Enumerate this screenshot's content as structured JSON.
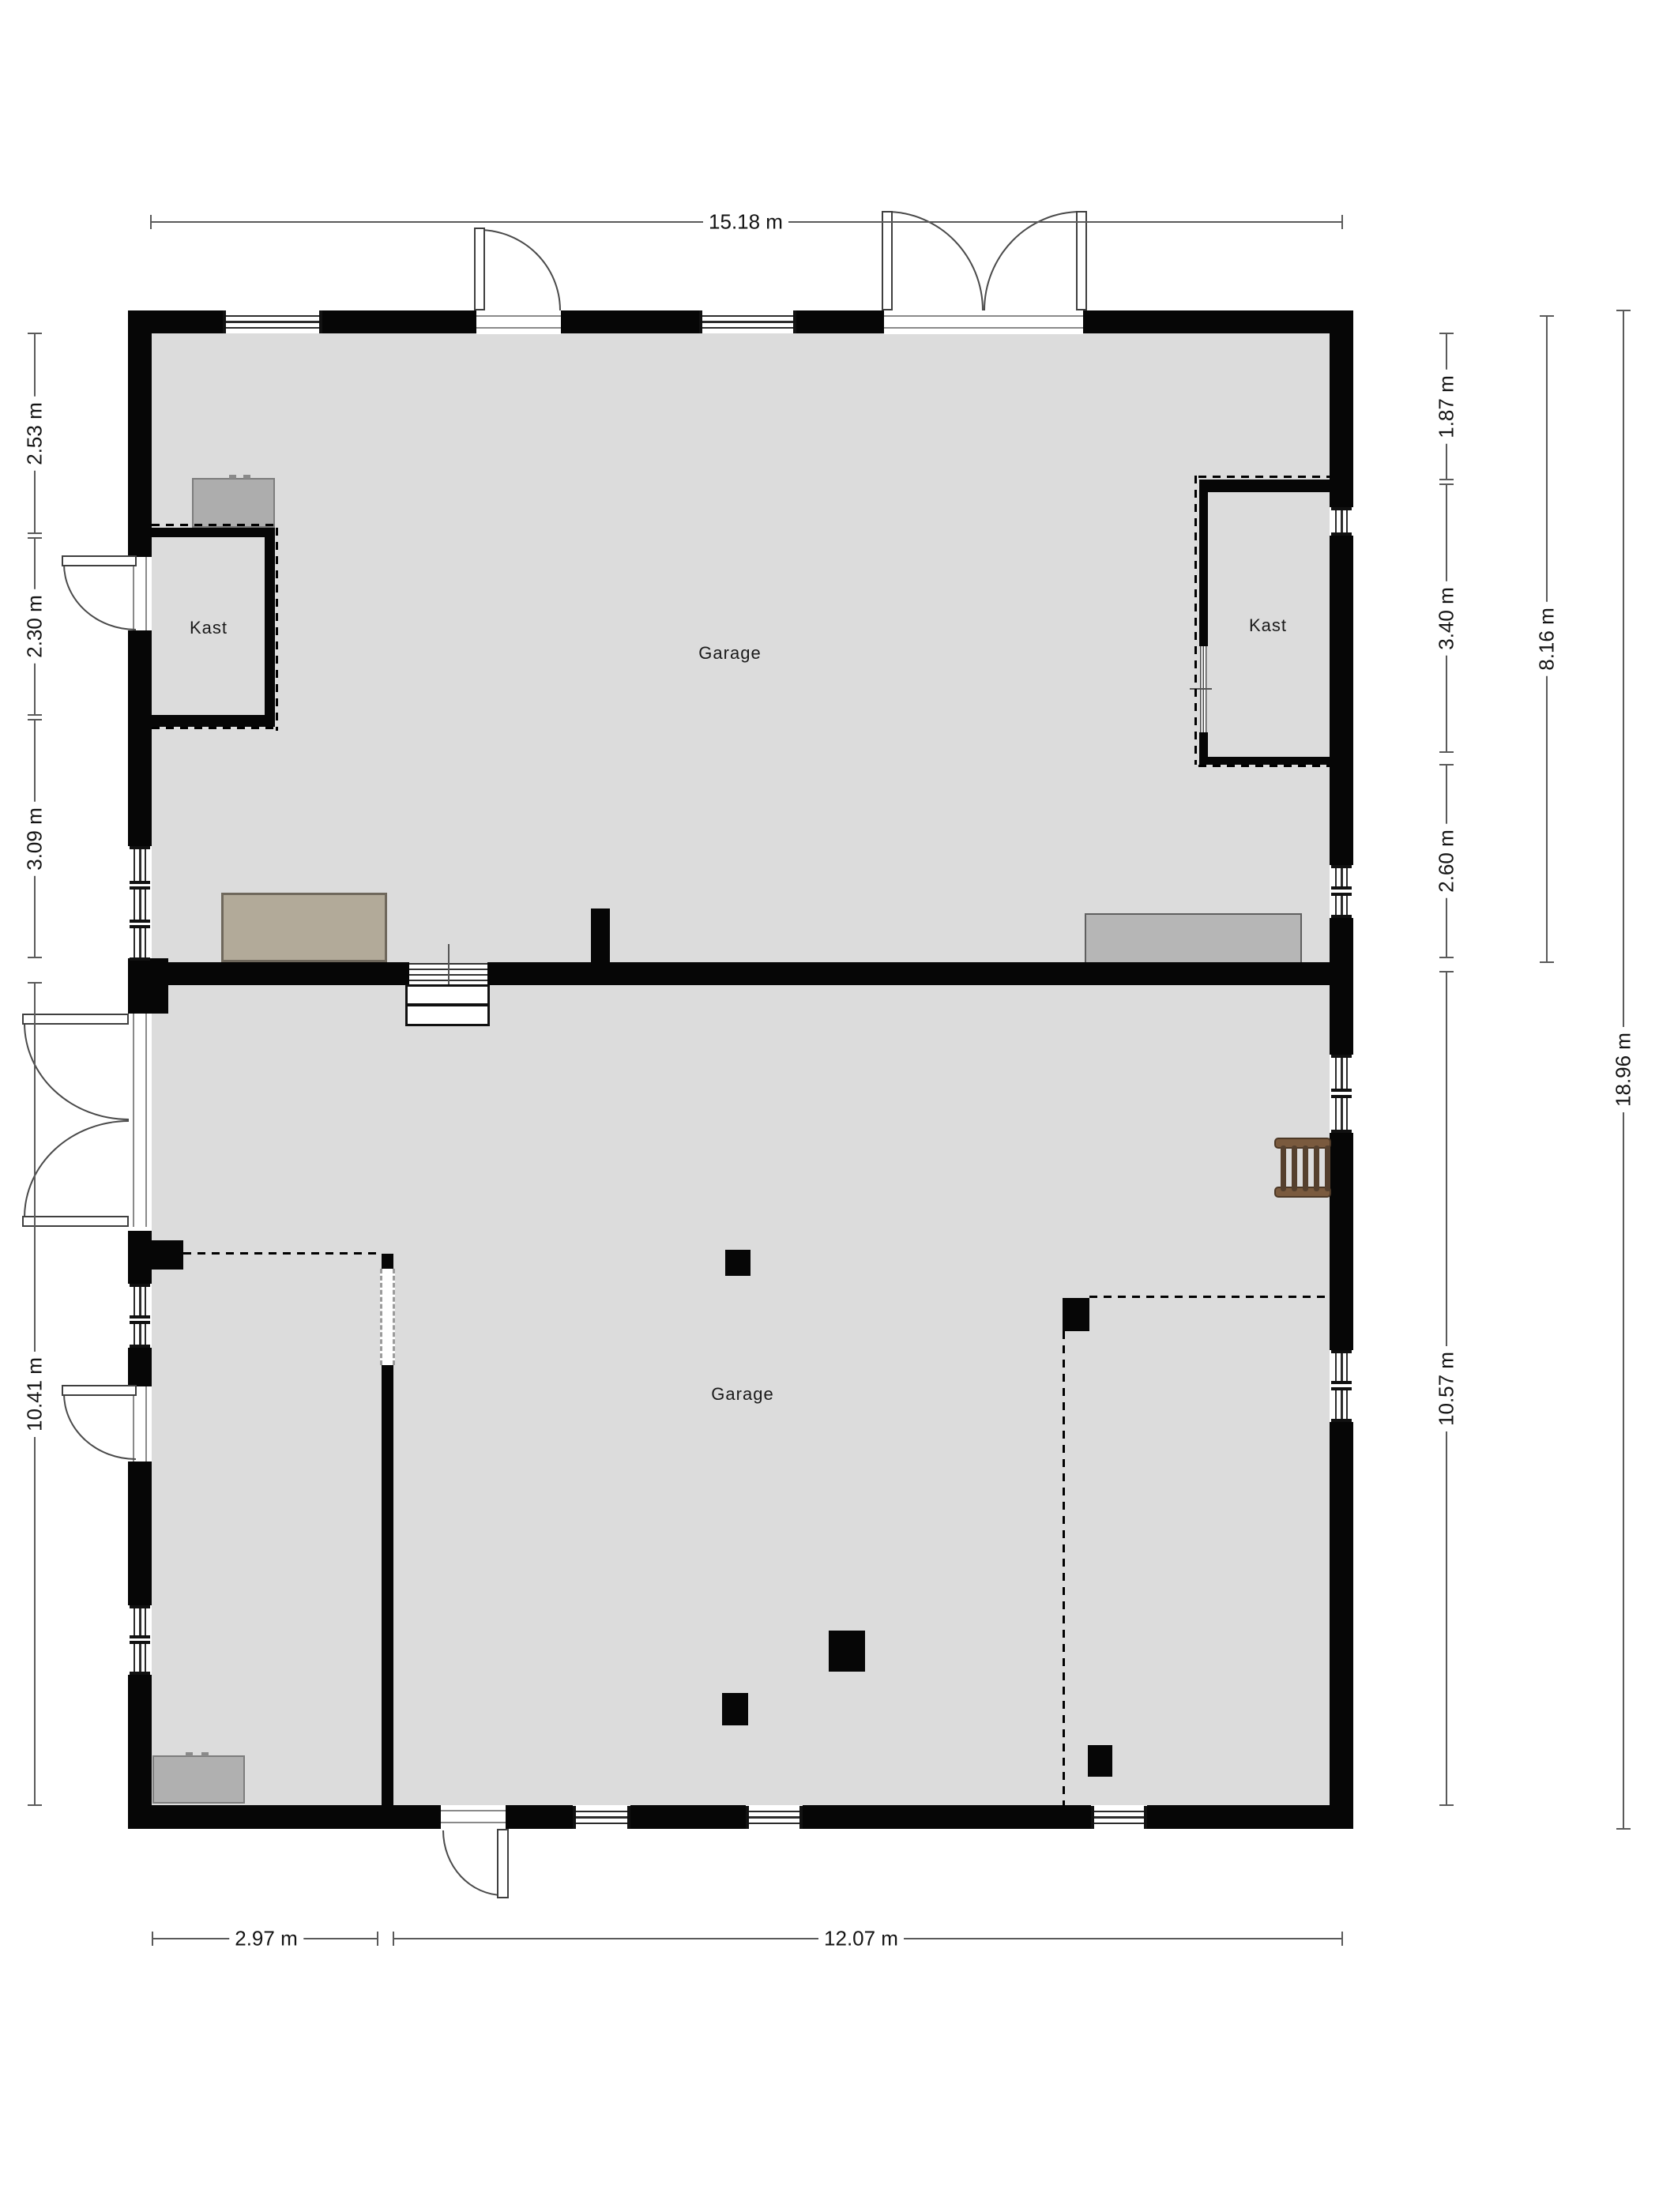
{
  "plan": {
    "rooms": [
      {
        "id": "garage-upper",
        "label": "Garage"
      },
      {
        "id": "garage-lower",
        "label": "Garage"
      },
      {
        "id": "kast-left",
        "label": "Kast"
      },
      {
        "id": "kast-right",
        "label": "Kast"
      }
    ],
    "dimensions": {
      "top_width": "15.18 m",
      "left": [
        "2.53 m",
        "2.30 m",
        "3.09 m",
        "10.41 m"
      ],
      "right_inner": [
        "1.87 m",
        "3.40 m",
        "2.60 m",
        "10.57 m"
      ],
      "right_total_upper": "8.16 m",
      "right_total": "18.96 m",
      "bottom": [
        "2.97 m",
        "12.07 m"
      ]
    },
    "colors": {
      "floor": "#dcdcdc",
      "wall": "#060606",
      "background": "#ffffff",
      "furniture_grey": "#b0b0b0",
      "workbench_tan": "#b2aa99",
      "ladder_brown": "#6e5138",
      "dimension_line": "#5a5a5a"
    }
  }
}
